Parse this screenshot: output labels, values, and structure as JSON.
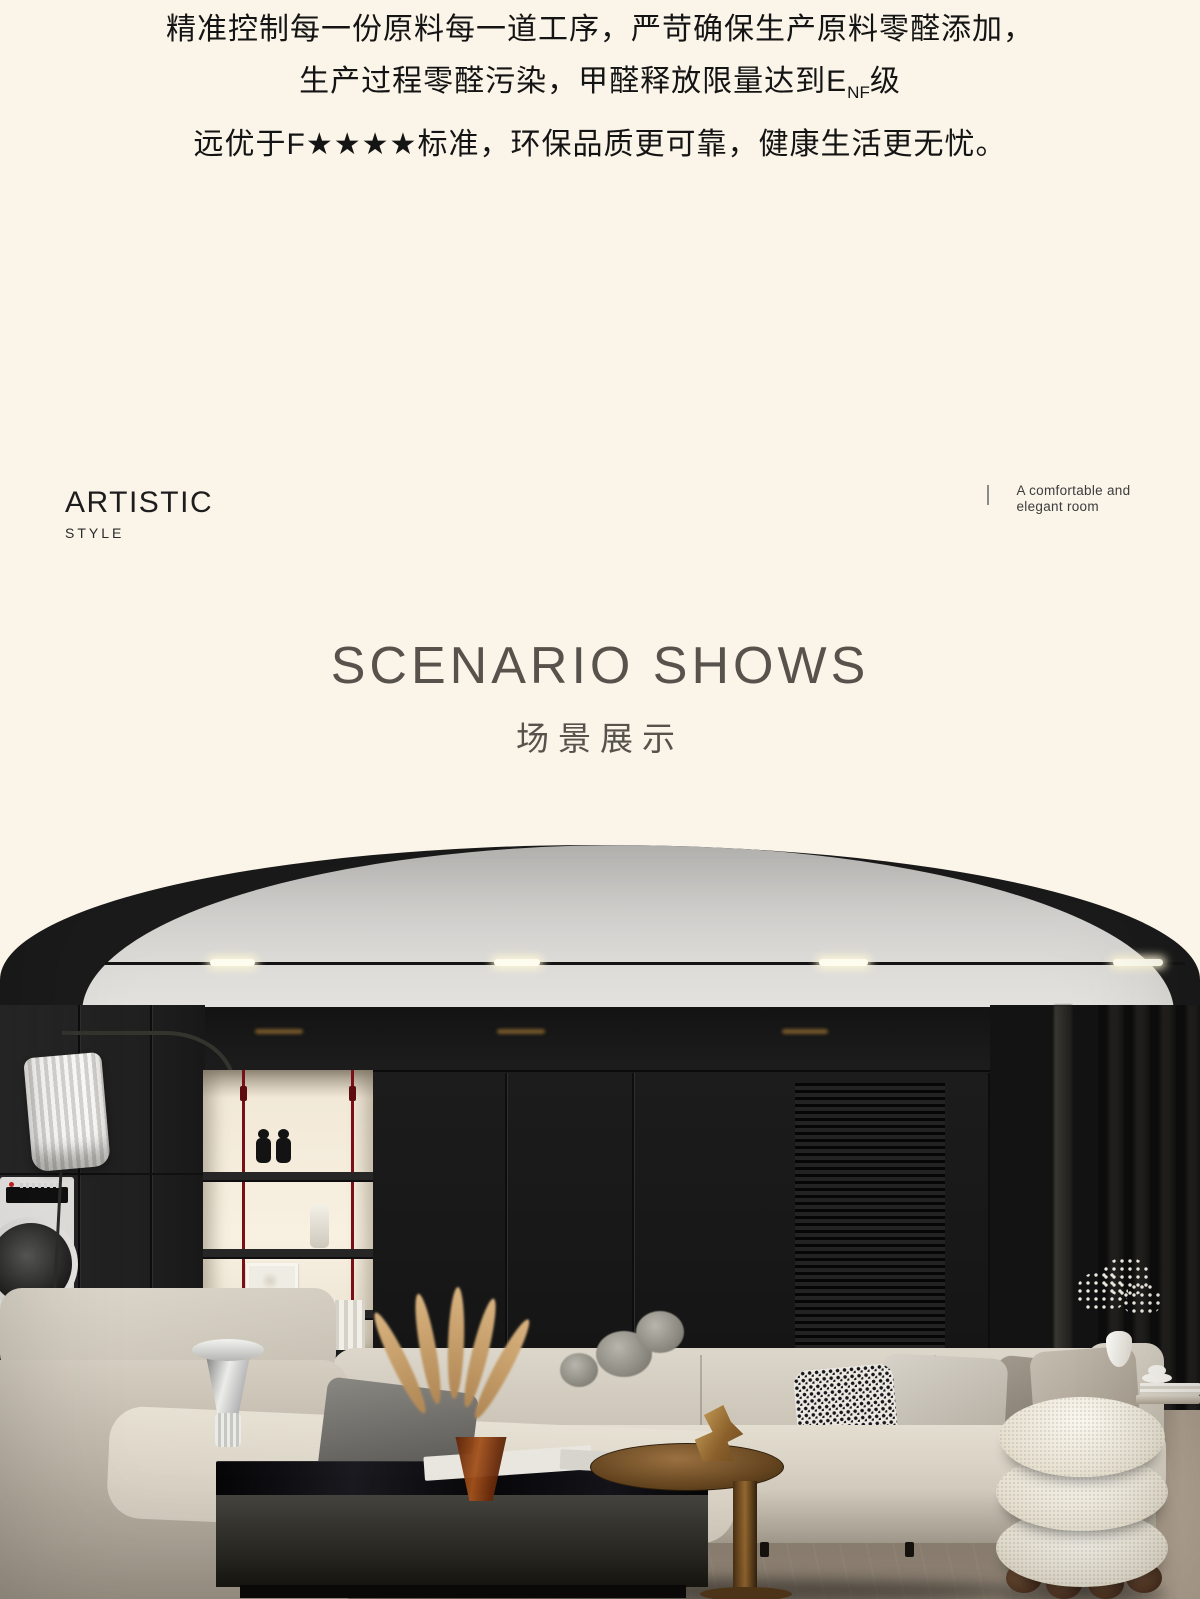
{
  "intro": {
    "line1": "精准控制每一份原料每一道工序，严苛确保生产原料零醛添加，",
    "line2_prefix": "生产过程零醛污染，甲醛释放限量达到E",
    "line2_sub": "NF",
    "line2_suffix": "级",
    "line3": "远优于F★★★★标准，环保品质更可靠，健康生活更无忧。"
  },
  "artistic": {
    "title": "ARTISTIC",
    "subtitle": "STYLE",
    "tagline_line1": "A comfortable and",
    "tagline_line2": "elegant room"
  },
  "scenario": {
    "title_en": "SCENARIO SHOWS",
    "title_cn": "场景展示"
  },
  "palette": {
    "page_background": "#faf4e9",
    "intro_text": "#141414",
    "heading_gray": "#57524c",
    "tagline_text": "#3c3c3c",
    "ceiling_gray": "#d6d5d2",
    "wall_black": "#1b1b1b",
    "niche_backlight": "#f8f0e1",
    "red_cable": "#7a1015",
    "sofa_beige": "#d8d2c6",
    "floor_brown": "#8a7e70",
    "amber_vase": "#a4521c",
    "bronze_table": "#95682f",
    "pouf_white": "#f3efe6"
  }
}
